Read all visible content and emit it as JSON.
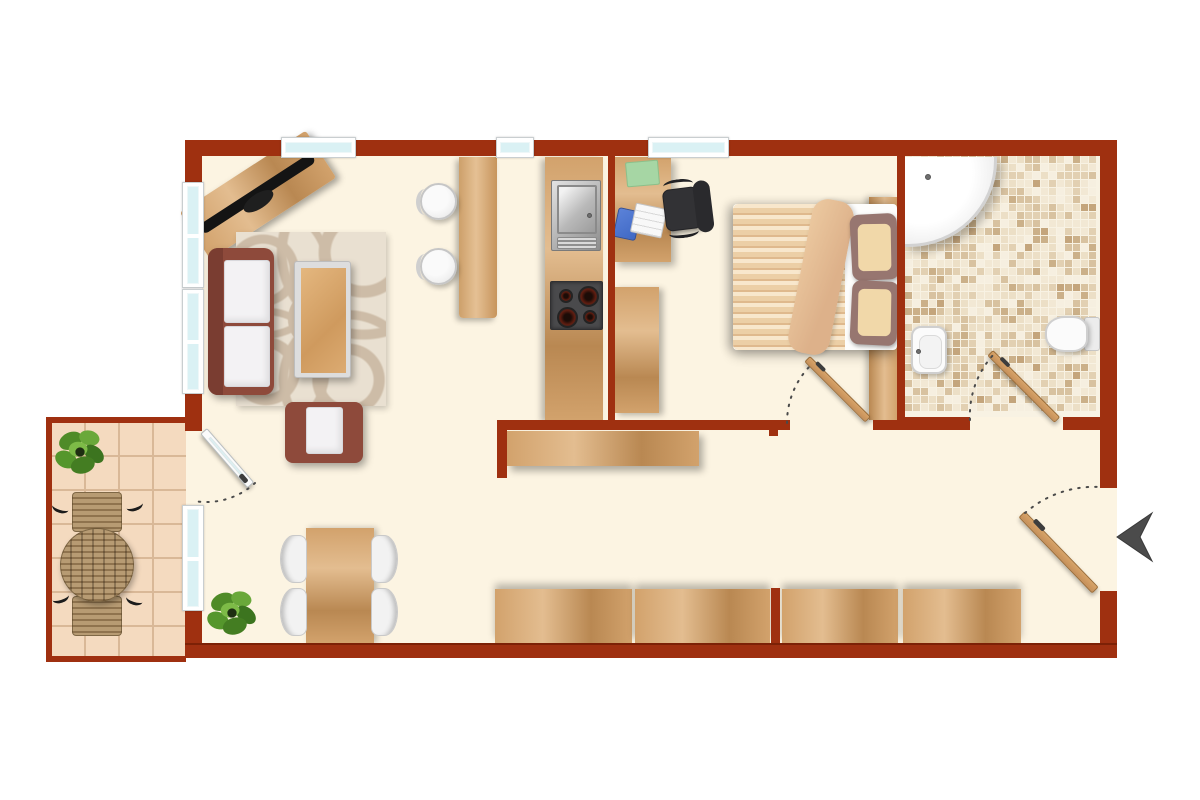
{
  "meta": {
    "title": "apartment-floor-plan-top-view",
    "text_labels": "none visible"
  },
  "colors": {
    "wall": "#9f3010",
    "wall_edge": "#7c2106",
    "floor": "#fcf4e2",
    "glass": "#daf1f4",
    "frame": "#ffffff",
    "frame_line": "#c9ced0",
    "wood": "#d2a26c",
    "wood_light": "#e3bd90",
    "wood_dark": "#b98852",
    "sofa": "#8e4a3b",
    "sofa_dark": "#7a3d31",
    "cushion": "#f3f2f4",
    "rug": "#e9e0d1",
    "rug_swirl": "#cdbca7",
    "silver": "#dddddd",
    "stool": "#f0f0f0",
    "stool_ring": "#c6c6c6",
    "stove": "#4a4a4c",
    "burner": "#601d10",
    "steel_light": "#e2e2e2",
    "steel_dark": "#8d8d8d",
    "chair_black": "#323235",
    "laptop_blue": "#3f68c5",
    "white": "#f8f8f8",
    "folder": "#a6d6a4",
    "duvet": "#eccfa6",
    "duvet_stripe": "#f8e7cc",
    "duvet_shade": "#dfb98d",
    "fold": "#ddb18a",
    "pillow": "#977670",
    "pillow_inner": "#f1d8a9",
    "sheet": "#fdfdfc",
    "tile_grout": "#f8f2e3",
    "shower": "#fefefe",
    "sanitary_edge": "#cfcfcf",
    "balcony_tile": "#f4dabf",
    "balcony_grout": "#d9b897",
    "slat": "#b79b73",
    "slat_dark": "#8f734e",
    "plant_dark": "#3c741f",
    "plant_mid": "#55962c",
    "plant_light": "#7dbb47",
    "arrow": "#4b4b4b",
    "door_wood": "#c6905a",
    "arc": "#4a4a4a"
  },
  "mosaic": {
    "palette": [
      "#f2e8d4",
      "#ecdfc6",
      "#e2d0b2",
      "#d8c2a0",
      "#cbb089",
      "#f6efe0",
      "#c4a57c"
    ],
    "weights": [
      0.28,
      0.2,
      0.16,
      0.12,
      0.08,
      0.12,
      0.04
    ],
    "cell": 7,
    "pitch": 8
  },
  "rooms": [
    {
      "name": "living-room",
      "furniture": [
        "tv-sideboard",
        "flatscreen-tv",
        "sofa",
        "coffee-table",
        "swirl-rug",
        "armchair",
        "bar-counter",
        "bar-stool",
        "bar-stool",
        "dining-table",
        "dining-chair-x4",
        "potted-plant"
      ]
    },
    {
      "name": "kitchen",
      "furniture": [
        "kitchen-counter",
        "double-sink",
        "four-burner-stove"
      ]
    },
    {
      "name": "bedroom-office",
      "furniture": [
        "desk",
        "office-chair",
        "laptop",
        "green-folder",
        "tall-cabinet",
        "double-bed",
        "headboard-panel",
        "pillow-x2"
      ]
    },
    {
      "name": "bathroom",
      "furniture": [
        "corner-shower",
        "bidet",
        "toilet"
      ],
      "floor": "mosaic-tile"
    },
    {
      "name": "hallway",
      "furniture": [
        "sideboard",
        "wall-cabinet-x4"
      ]
    },
    {
      "name": "balcony",
      "furniture": [
        "round-slat-table",
        "slat-chair-x2",
        "potted-plant"
      ],
      "floor": "square-tile"
    }
  ],
  "windows": {
    "top_wall": 3,
    "left_wall": 3
  },
  "doors": [
    "balcony-door-glazed",
    "bedroom-door",
    "bathroom-door",
    "entrance-door"
  ],
  "entrance": {
    "arrow_direction": "left"
  }
}
